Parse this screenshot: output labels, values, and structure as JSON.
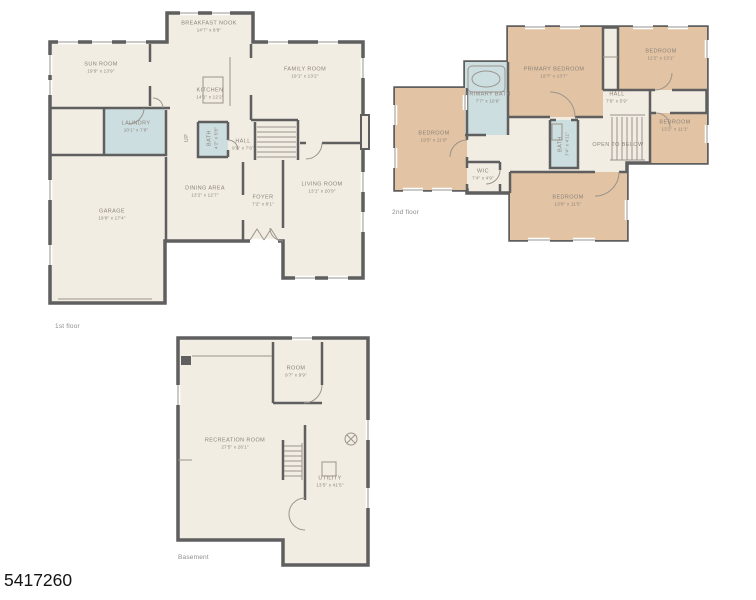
{
  "meta": {
    "listing_id": "5417260"
  },
  "colors": {
    "floor_fill": "#f2ede3",
    "bedroom_fill": "#e2c3a4",
    "bath_fill": "#cddee1",
    "wall": "#5f5f5f",
    "label_text": "#8b8379"
  },
  "floors": [
    {
      "caption": "1st floor",
      "caption_pos": {
        "x": 55,
        "y": 323
      },
      "rooms": [
        {
          "name": "BREAKFAST NOOK",
          "dims": "14'7\" x 8'8\"",
          "x": 209,
          "y": 27
        },
        {
          "name": "SUN ROOM",
          "dims": "19'9\" x 13'9\"",
          "x": 101,
          "y": 68
        },
        {
          "name": "FAMILY ROOM",
          "dims": "19'1\" x 13'2\"",
          "x": 305,
          "y": 73
        },
        {
          "name": "KITCHEN",
          "dims": "14'1\" x 12'2\"",
          "x": 210,
          "y": 94
        },
        {
          "name": "LAUNDRY",
          "dims": "10'1\" x 7'8\"",
          "x": 136,
          "y": 127
        },
        {
          "name": "BATH",
          "dims": "4'2\" x 5'8\"",
          "x": 213,
          "y": 138,
          "rotated": true
        },
        {
          "name": "UP",
          "dims": "",
          "x": 187,
          "y": 138,
          "rotated": true
        },
        {
          "name": "HALL",
          "dims": "9'9\" x 7'6\"",
          "x": 243,
          "y": 145
        },
        {
          "name": "GARAGE",
          "dims": "19'8\" x 17'4\"",
          "x": 112,
          "y": 215
        },
        {
          "name": "DINING AREA",
          "dims": "13'2\" x 12'7\"",
          "x": 205,
          "y": 192
        },
        {
          "name": "FOYER",
          "dims": "7'2\" x 8'1\"",
          "x": 263,
          "y": 201
        },
        {
          "name": "LIVING ROOM",
          "dims": "13'1\" x 20'9\"",
          "x": 322,
          "y": 188
        }
      ]
    },
    {
      "caption": "2nd floor",
      "caption_pos": {
        "x": 392,
        "y": 209
      },
      "rooms": [
        {
          "name": "BEDROOM",
          "dims": "19'5\" x 11'9\"",
          "x": 434,
          "y": 137
        },
        {
          "name": "PRIMARY BATH",
          "dims": "7'7\" x 10'6\"",
          "x": 488,
          "y": 98
        },
        {
          "name": "PRIMARY BEDROOM",
          "dims": "19'7\" x 13'7\"",
          "x": 554,
          "y": 73
        },
        {
          "name": "BEDROOM",
          "dims": "11'2\" x 13'1\"",
          "x": 661,
          "y": 55
        },
        {
          "name": "HALL",
          "dims": "7'6\" x 5'9\"",
          "x": 617,
          "y": 98
        },
        {
          "name": "BEDROOM",
          "dims": "13'2\" x 11'1\"",
          "x": 675,
          "y": 126
        },
        {
          "name": "WIC",
          "dims": "7'4\" x 4'9\"",
          "x": 483,
          "y": 175
        },
        {
          "name": "BATH",
          "dims": "7'4\" x 4'11\"",
          "x": 564,
          "y": 144,
          "rotated": true
        },
        {
          "name": "OPEN TO BELOW",
          "dims": "",
          "x": 618,
          "y": 145
        },
        {
          "name": "BEDROOM",
          "dims": "13'8\" x 11'5\"",
          "x": 568,
          "y": 201
        }
      ]
    },
    {
      "caption": "Basement",
      "caption_pos": {
        "x": 178,
        "y": 554
      },
      "rooms": [
        {
          "name": "ROOM",
          "dims": "9'7\" x 9'9\"",
          "x": 296,
          "y": 372
        },
        {
          "name": "RECREATION ROOM",
          "dims": "27'5\" x 26'1\"",
          "x": 235,
          "y": 444
        },
        {
          "name": "UTILITY",
          "dims": "13'5\" x 41'5\"",
          "x": 330,
          "y": 482
        }
      ]
    }
  ]
}
